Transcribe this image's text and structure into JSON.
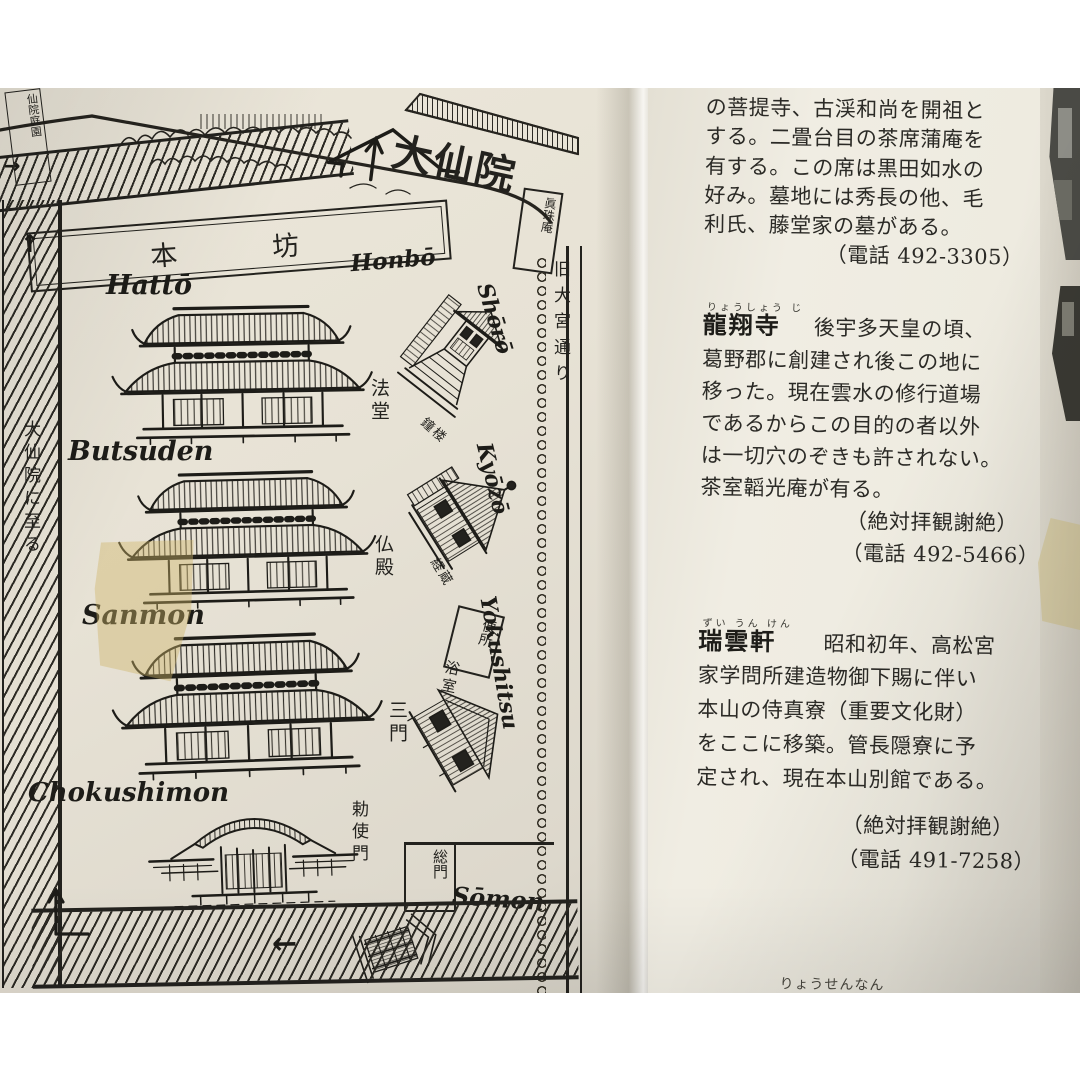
{
  "colors": {
    "paper_left": "#e7e2d5",
    "paper_right": "#efece2",
    "ink": "#23221e",
    "tape": "#d0b668"
  },
  "icons": {
    "up_arrow": "↑",
    "left_arrow": "←",
    "right_arrow": "→"
  },
  "map": {
    "garden_label": "仙院庭園",
    "daisenin": "大仙院",
    "honbo_kanji": "本坊",
    "honbo_romaji": "Honbō",
    "shinjuan": "眞珠庵",
    "street": "旧大宮通り",
    "to_daisenin": "大仙院に至る",
    "buildings": [
      {
        "romaji": "Hattō",
        "kanji": "法堂"
      },
      {
        "romaji": "Butsuden",
        "kanji": "仏殿"
      },
      {
        "romaji": "Sanmon",
        "kanji": "三門"
      },
      {
        "romaji": "Chokushimon",
        "kanji": "勅使門"
      }
    ],
    "side": [
      {
        "romaji": "Shōrō",
        "kanji": "鐘楼"
      },
      {
        "romaji": "Kyōzō",
        "kanji": "経蔵"
      },
      {
        "romaji": "Yokushitsu",
        "kanji": "浴室"
      }
    ],
    "toilet": "便所",
    "somon_kanji": "総門",
    "somon_romaji": "Sōmon"
  },
  "text_page": {
    "para1": [
      "の菩提寺、古渓和尚を開祖と",
      "する。二畳台目の茶席蒲庵を",
      "有する。この席は黒田如水の",
      "好み。墓地には秀長の他、毛",
      "利氏、藤堂家の墓がある。"
    ],
    "para1_phone": "（電話 492-3305）",
    "entries": [
      {
        "furigana": "りょうしょう じ",
        "name": "龍翔寺",
        "first_line": "後宇多天皇の頃、",
        "lines": [
          "葛野郡に創建され後この地に",
          "移った。現在雲水の修行道場",
          "であるからこの目的の者以外",
          "は一切穴のぞきも許されない。",
          "茶室韜光庵が有る。"
        ],
        "notes": [
          "（絶対拝観謝絶）",
          "（電話 492-5466）"
        ]
      },
      {
        "furigana": "ずい うん けん",
        "name": "瑞雲軒",
        "first_line": "昭和初年、高松宮",
        "lines": [
          "家学問所建造物御下賜に伴い",
          "本山の侍真寮（重要文化財）",
          "をここに移築。管長隠寮に予",
          "定され、現在本山別館である。"
        ],
        "notes": [
          "（絶対拝観謝絶）",
          "（電話 491-7258）"
        ]
      }
    ],
    "footer": "りょうせんなん"
  }
}
